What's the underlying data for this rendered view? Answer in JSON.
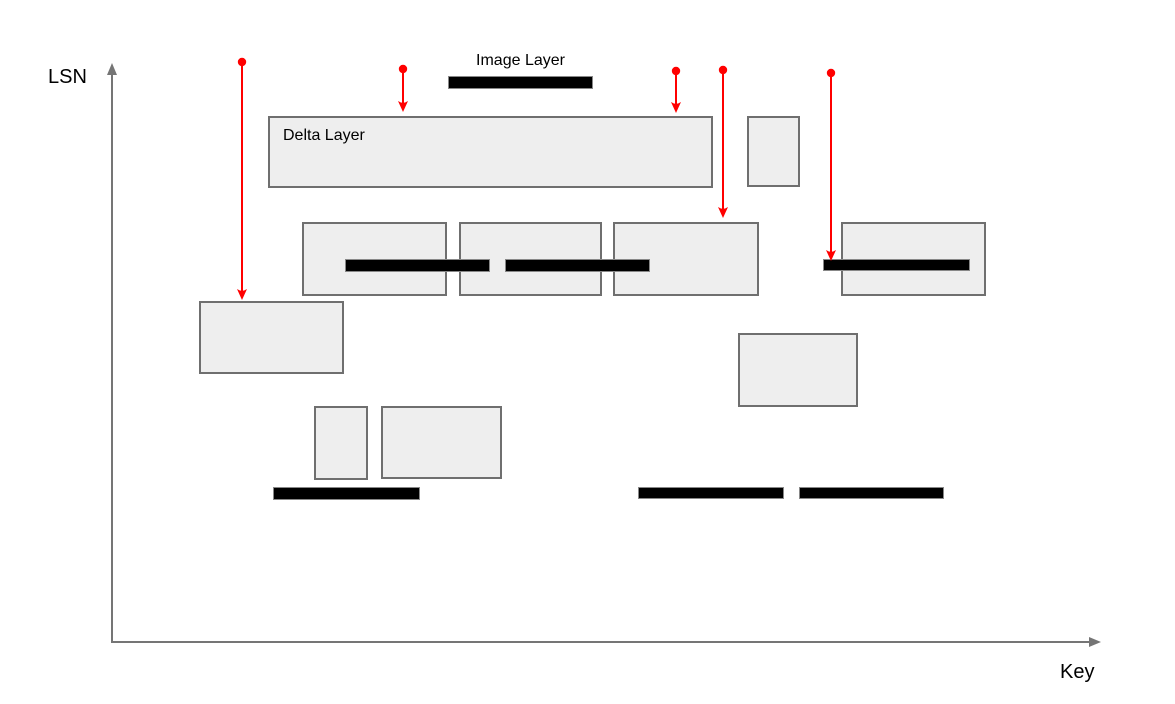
{
  "axes": {
    "y_label": "LSN",
    "x_label": "Key"
  },
  "legend": {
    "image_layer_label": "Image Layer",
    "legend_bar": {
      "x": 448,
      "y": 76,
      "w": 145,
      "h": 13
    }
  },
  "colors": {
    "delta_fill": "#eeeeee",
    "delta_border": "#6f6f6f",
    "image_fill": "#000000",
    "image_border": "#888888",
    "arrow_red": "#ff0000",
    "axis_gray": "#757575",
    "text": "#000000"
  },
  "delta_layers": [
    {
      "label": "Delta Layer",
      "x": 268,
      "y": 116,
      "w": 445,
      "h": 72
    },
    {
      "x": 747,
      "y": 116,
      "w": 53,
      "h": 71
    },
    {
      "x": 302,
      "y": 222,
      "w": 145,
      "h": 74
    },
    {
      "x": 459,
      "y": 222,
      "w": 143,
      "h": 74
    },
    {
      "x": 613,
      "y": 222,
      "w": 146,
      "h": 74
    },
    {
      "x": 841,
      "y": 222,
      "w": 145,
      "h": 74
    },
    {
      "x": 199,
      "y": 301,
      "w": 145,
      "h": 73
    },
    {
      "x": 738,
      "y": 333,
      "w": 120,
      "h": 74
    },
    {
      "x": 314,
      "y": 406,
      "w": 54,
      "h": 74
    },
    {
      "x": 381,
      "y": 406,
      "w": 121,
      "h": 73
    }
  ],
  "image_layers": [
    {
      "x": 345,
      "y": 259,
      "w": 145,
      "h": 13
    },
    {
      "x": 505,
      "y": 259,
      "w": 145,
      "h": 13
    },
    {
      "x": 823,
      "y": 259,
      "w": 147,
      "h": 12
    },
    {
      "x": 273,
      "y": 487,
      "w": 147,
      "h": 13
    },
    {
      "x": 638,
      "y": 487,
      "w": 146,
      "h": 12
    },
    {
      "x": 799,
      "y": 487,
      "w": 145,
      "h": 12
    }
  ],
  "arrows": [
    {
      "x": 242,
      "y_top": 62,
      "y_tip": 300
    },
    {
      "x": 403,
      "y_top": 69,
      "y_tip": 112
    },
    {
      "x": 676,
      "y_top": 71,
      "y_tip": 113
    },
    {
      "x": 723,
      "y_top": 70,
      "y_tip": 218
    },
    {
      "x": 831,
      "y_top": 73,
      "y_tip": 261
    }
  ]
}
